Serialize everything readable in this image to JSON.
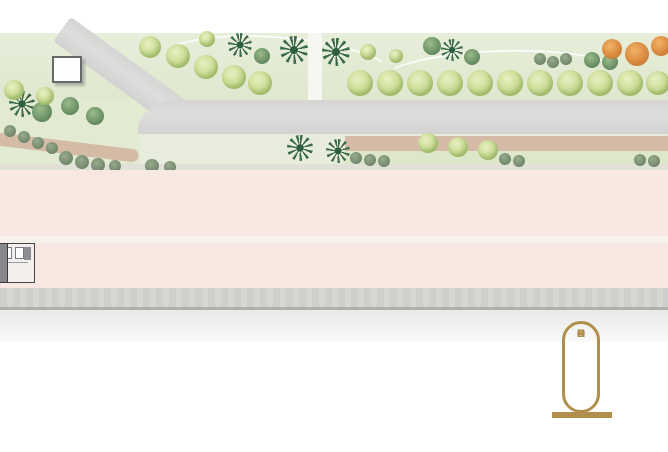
{
  "plan": {
    "kind": "site-plan",
    "floor_label": "T 1"
  },
  "building": {
    "unit_type": "Office",
    "top_row": [
      {
        "area": "31.00",
        "code": "T 1- 01"
      },
      {
        "area": "31.00",
        "code": "T 1- 02"
      },
      {
        "area": "31.00",
        "code": "T 1- 03"
      },
      {
        "area": "31.00",
        "code": "T 1- 04"
      },
      {
        "area": "31.00",
        "code": "T 1- 05"
      },
      {
        "area": "31.00",
        "code": "T 1- 06"
      },
      {
        "area": "29.00",
        "code": "T 1- 07"
      },
      {
        "area": "29.00",
        "code": "T 1- 08"
      },
      {
        "area": "29.00",
        "code": "T 1- 09"
      },
      {
        "area": "29.00",
        "code": "T 1- 10"
      },
      {
        "area": "29.00",
        "code": "T 1- 11"
      },
      {
        "area": "29.00",
        "code": "T 1- 12"
      },
      {
        "area": "29.00",
        "code": "T 1- 13"
      },
      {
        "area": "29.00",
        "code": "T 1- 14"
      },
      {
        "area": "29.00",
        "code": "T 1- 15"
      },
      {
        "area": "29.00",
        "code": "T 1- 16"
      },
      {
        "area": "29.00",
        "code": "T 1- 17"
      },
      {
        "area": "29.00",
        "code": "T 1- 18"
      },
      {
        "area": "29.00",
        "code": "T 1- 19"
      },
      {
        "area": "29.00",
        "code": "T 1- 20"
      },
      {
        "area": "31.00",
        "code": "T 1- 21"
      },
      {
        "area": "31.00",
        "code": "T 1- 22"
      },
      {
        "area": "31.00",
        "code": "T 1- 23"
      },
      {
        "area": "31.00",
        "code": "T 1- 24"
      },
      {
        "area": "31.00",
        "code": "T 1- 25"
      }
    ],
    "bottom_row_left": [
      {
        "area": "33.00",
        "code": "T 1- 26"
      },
      {
        "area": "33.00",
        "code": "T 1- 27"
      },
      {
        "area": "33.00",
        "code": "T 1- 28"
      },
      {
        "area": "33.00",
        "code": "T 1- 29"
      },
      {
        "area": "33.00",
        "code": "T 1- 30"
      },
      {
        "area": "33.00",
        "code": "T 1- 31"
      },
      {
        "area": "33.00",
        "code": "T 1- 32"
      },
      {
        "area": "33.00",
        "code": "T 1- 33"
      },
      {
        "area": "33.00",
        "code": "T 1- 34"
      },
      {
        "area": "33.00",
        "code": "T 1- 35"
      },
      {
        "area": "33.00",
        "code": "T 1- 36"
      },
      {
        "area": "34.00",
        "code": "T 1- 37"
      }
    ],
    "bottom_row_right": [
      {
        "area": "34.00",
        "code": "T 1- 38"
      },
      {
        "area": "33.00",
        "code": "T 1- 39"
      },
      {
        "area": "33.00",
        "code": "T 1- 40"
      },
      {
        "area": "33.00",
        "code": "T 1- 41"
      },
      {
        "area": "33.00",
        "code": "T 1- 42"
      },
      {
        "area": "33.00",
        "code": "T 1- 43"
      },
      {
        "area": "33.00",
        "code": "T 1- 44"
      },
      {
        "area": "33.00",
        "code": "T 1- 45"
      },
      {
        "area": "33.00",
        "code": "T 1- 46"
      },
      {
        "area": "33.00",
        "code": "T 1- 47"
      },
      {
        "area": "33.00",
        "code": "T 1- 48"
      }
    ]
  },
  "logo": {
    "text": "PHAROS"
  },
  "colors": {
    "logo_gold": "#B28E4C",
    "pink_band": "#F9E8E1",
    "unit_fill": "#CCC9CC",
    "wall": "#3F3F42",
    "road": "#D8D7D5",
    "lawn": "#E3EAD4",
    "tree_light": "#C9DB96",
    "tree_dark": "#6E9468",
    "terracotta": "#CFAB96",
    "orange_tree": "#D98A3F"
  }
}
